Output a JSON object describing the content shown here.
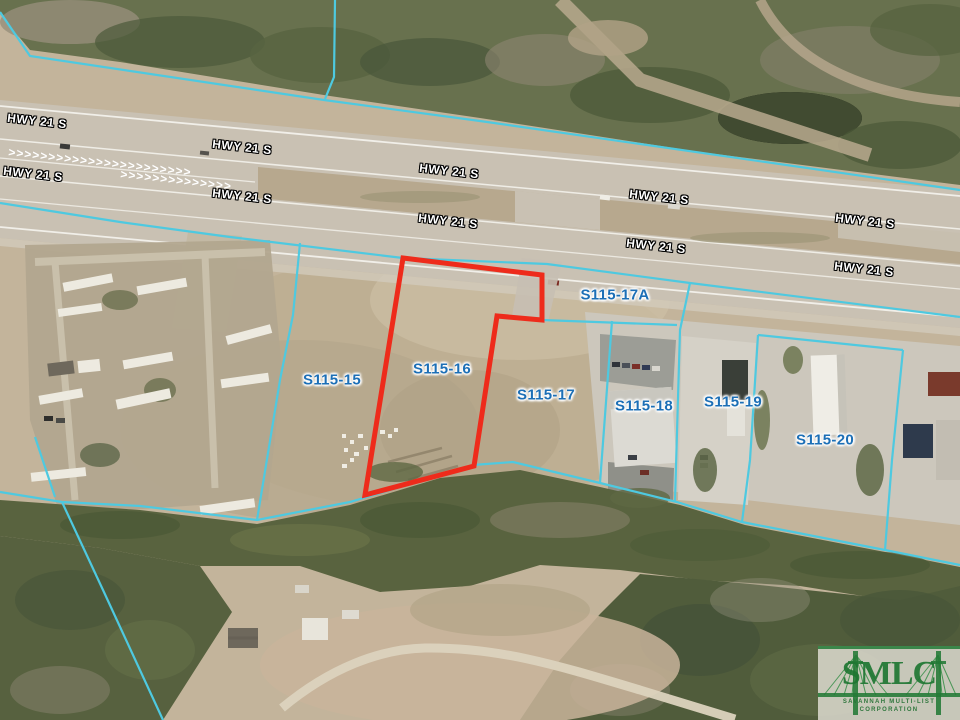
{
  "map": {
    "description": "aerial parcel map",
    "highway_labels": {
      "text": "HWY 21 S",
      "color": "#FFFFFF",
      "rotation_deg": 6.3,
      "positions": [
        {
          "x": 37,
          "y": 121
        },
        {
          "x": 242,
          "y": 147
        },
        {
          "x": 449,
          "y": 171
        },
        {
          "x": 659,
          "y": 197
        },
        {
          "x": 865,
          "y": 221
        },
        {
          "x": 33,
          "y": 174
        },
        {
          "x": 242,
          "y": 196
        },
        {
          "x": 448,
          "y": 221
        },
        {
          "x": 656,
          "y": 246
        },
        {
          "x": 864,
          "y": 269
        }
      ]
    },
    "parcel_labels": {
      "color": "#1C6FB6",
      "items": [
        {
          "id": "S115-15",
          "x": 332,
          "y": 380
        },
        {
          "id": "S115-16",
          "x": 442,
          "y": 369
        },
        {
          "id": "S115-17",
          "x": 546,
          "y": 395
        },
        {
          "id": "S115-17A",
          "x": 615,
          "y": 295
        },
        {
          "id": "S115-18",
          "x": 644,
          "y": 406
        },
        {
          "id": "S115-19",
          "x": 733,
          "y": 402
        },
        {
          "id": "S115-20",
          "x": 825,
          "y": 440
        }
      ]
    },
    "subject_parcel": {
      "id": "S115-16",
      "outline_color": "#EE2B1B",
      "outline_width": 5,
      "points": "403,258 542,275 542,320 497,316 474,466 365,495"
    },
    "boundary_lines": {
      "color": "#4EC9E0",
      "width": 2.2,
      "polylines": [
        "0,12 30,56 324,100 480,121 960,190",
        "335,0 334,77 325,99",
        "0,203 120,222 230,237 403,258 547,264 690,283 960,317",
        "300,243 293,315 280,380 257,520",
        "0,492 62,502 140,506 257,520 350,502 473,465 513,462 600,483 677,502 742,522 885,550 960,565",
        "62,502 103,590 163,720",
        "35,437 55,497",
        "542,320 677,325",
        "612,321 600,483",
        "690,283 680,330 675,501",
        "758,335 750,460 742,522",
        "758,335 903,350",
        "903,350 892,460 885,550"
      ]
    }
  },
  "logo": {
    "abbr": "SMLC",
    "name_line1": "SAVANNAH MULTI-LIST",
    "name_line2": "CORPORATION",
    "green": "#227A36"
  }
}
